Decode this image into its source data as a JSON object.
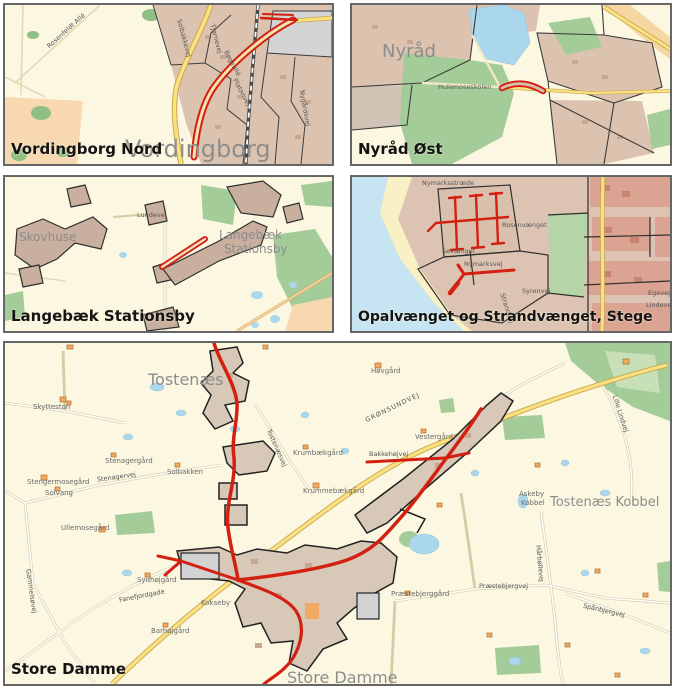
{
  "colors": {
    "route_red": "#D32011",
    "map_background": "#FBF7E0",
    "road_yellow": "#FBE184"
  },
  "panels": {
    "vordingborg_nord": {
      "title": "Vordingborg Nord",
      "city": "Vordingborg",
      "streets": {
        "s1": "Rosenfeldt Allé",
        "s2": "Solbakkevej",
        "s3": "Tjørnevej",
        "s4": "Bøgeallé",
        "s5": "Platanvej",
        "s6": "Nygårdsvej"
      }
    },
    "nyraad_oest": {
      "title": "Nyråd Øst",
      "city": "Nyråd",
      "streets": {
        "s1": "Hulemoseskolen"
      }
    },
    "langebaek": {
      "title": "Langebæk Stationsby",
      "place1": "Skovhuse",
      "place2a": "Langebæk",
      "place2b": "Stationsby",
      "streets": {
        "s1": "Lundevej"
      }
    },
    "stege": {
      "title": "Opalvænget og Strandvænget, Stege",
      "streets": {
        "s1": "Nymarksstræde",
        "s2": "Søvænget",
        "s3": "Nymarksvej",
        "s4": "Rosenvænget",
        "s5": "Syrenvej",
        "s6": "Strandvej",
        "s7": "Egevej",
        "s8": "Lindevej"
      }
    },
    "store_damme": {
      "title": "Store Damme",
      "places": {
        "tostenaes": "Tostenæs",
        "tostenaes_kobbel": "Tostenæs Kobbel",
        "store_damme": "Store Damme",
        "skytteston": "Skytteston",
        "stenagergaard": "Stenagergård",
        "solbakken": "Solbakken",
        "stengermosegaard": "Stengermosegård",
        "solvang": "Solvang",
        "krumbaekgaard": "Krumbækgård",
        "krummebaekgaard": "Krummebækgård",
        "hoevgaard": "Høvgård",
        "vestergaard": "Vestergård",
        "askeby": "Askeby",
        "kobbel": "Kobbel",
        "ullemosegaard": "Ullemosegård",
        "sydhoejgaard": "Sydhøjgård",
        "barhoejgaard": "Barhøjgård",
        "kokseby": "Kokseby",
        "praestebjerggaard": "Præstebjerggård"
      },
      "roads": {
        "stenagervej": "Stenagervej",
        "groensundvej": "GRØNSUNDVEJ",
        "bakkehoejvej": "Bakkehøjvej",
        "tostenaesvej": "Tostenæsvej",
        "lille_lindvej": "Lille Lindvej",
        "fanefjordgade": "Fanefjordgade",
        "gammelsoevej": "Gammelsøvej",
        "praestebjergvej": "Præstebjergvej",
        "haarboellevej": "Hårbøllevej",
        "spaanbjergvej": "Spånbjergvej"
      }
    }
  }
}
